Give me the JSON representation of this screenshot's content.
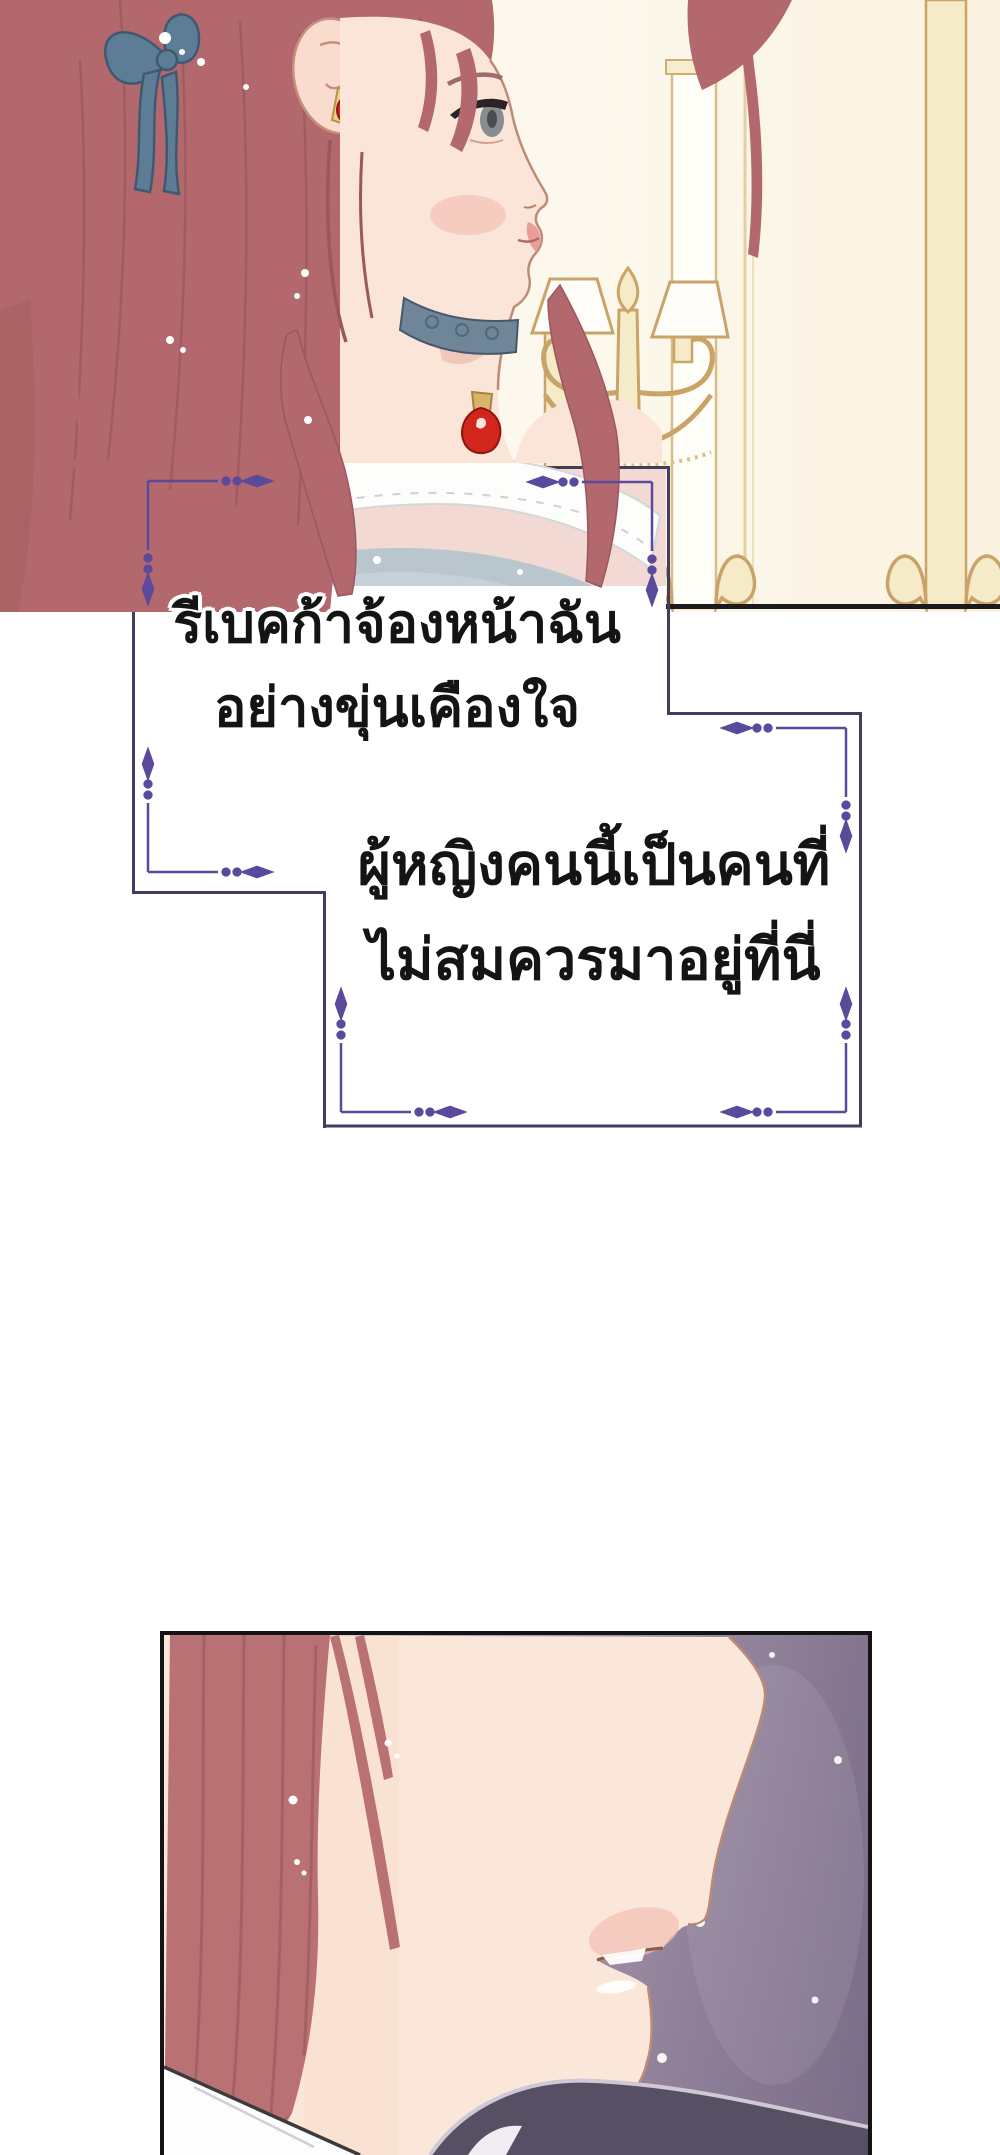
{
  "page": {
    "width_px": 1000,
    "height_px": 2155,
    "background": "#ffffff"
  },
  "captions": {
    "narration_1": {
      "lines": [
        "รีเบคก้าจ้องหน้าฉัน",
        "อย่างขุ่นเคืองใจ"
      ]
    },
    "narration_2": {
      "lines": [
        "ผู้หญิงคนนี้เป็นคนที่",
        "ไม่สมควรมาอยู่ที่นี่"
      ]
    }
  },
  "palette": {
    "page_bg": "#ffffff",
    "ink": "#141414",
    "panel_border": "#141414",
    "hair": "#b2686c",
    "hair_line": "#9a585e",
    "skin": "#fbe5d8",
    "blush": "#f2bdb3",
    "ribbon": "#5d7d96",
    "choker": "#6f8598",
    "gem": "#d2261c",
    "gold": "#c9a368",
    "gold_fill": "#f6ebc8",
    "bodice": "#b9c6cd",
    "frame_outer": "#423c5f",
    "frame_accent": "#5b4a9c",
    "panel2_hair": "#b97173",
    "panel2_skin": "#fbe7d9",
    "shoulder_dark": "#575064",
    "shoulder_rim": "#cfc9d6",
    "collar_white": "#fdfdfd",
    "art_edge_black": "#1b1b1b"
  }
}
